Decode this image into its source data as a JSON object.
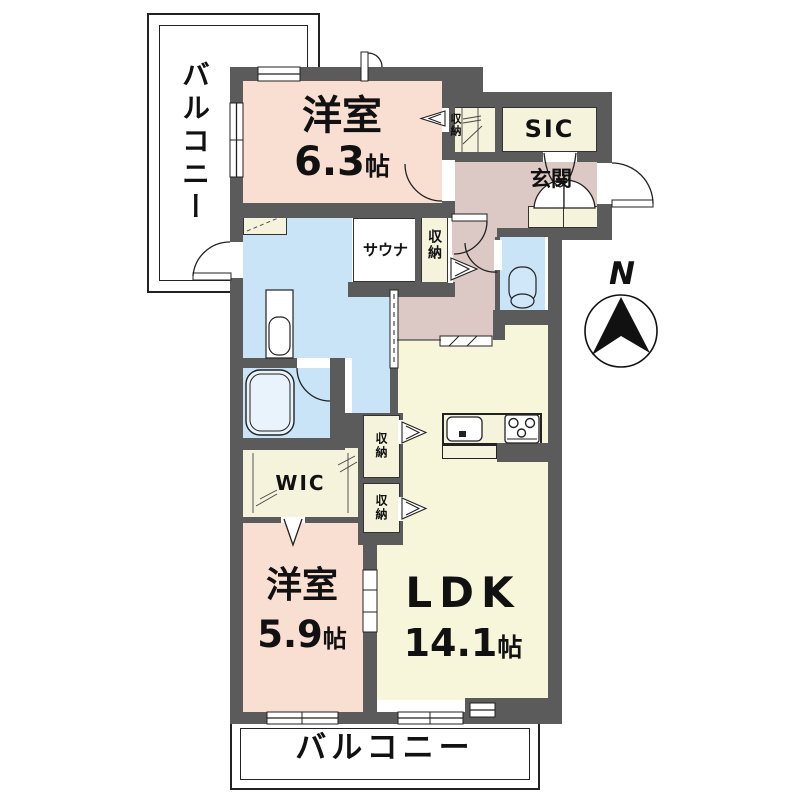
{
  "rooms": {
    "bedroom1": {
      "label": "洋室",
      "size_num": "6.3",
      "size_unit": "帖"
    },
    "bedroom2": {
      "label": "洋室",
      "size_num": "5.9",
      "size_unit": "帖"
    },
    "ldk": {
      "label": "LDK",
      "size_num": "14.1",
      "size_unit": "帖"
    },
    "sauna": {
      "label": "サウナ"
    },
    "sic": {
      "label": "SIC"
    },
    "genkan": {
      "label": "玄関"
    },
    "wic": {
      "label": "WIC"
    },
    "storage_top": {
      "label": "収納"
    },
    "storage_hall": {
      "label": "収納"
    },
    "storage_ldk_a": {
      "label": "収納"
    },
    "storage_ldk_b": {
      "label": "収納"
    },
    "balcony_top": {
      "label": "バルコニー"
    },
    "balcony_bottom": {
      "label": "バルコニー"
    }
  },
  "compass": {
    "label": "N"
  },
  "colors": {
    "wall": "#5b5b5b",
    "bedroom_pink": "#f9dfd2",
    "ldk_cream": "#f8f6da",
    "closet_cream": "#f6f3dd",
    "hall_mauve": "#dcc8c4",
    "water_blue": "#c9e4f7",
    "outline": "#222222"
  }
}
